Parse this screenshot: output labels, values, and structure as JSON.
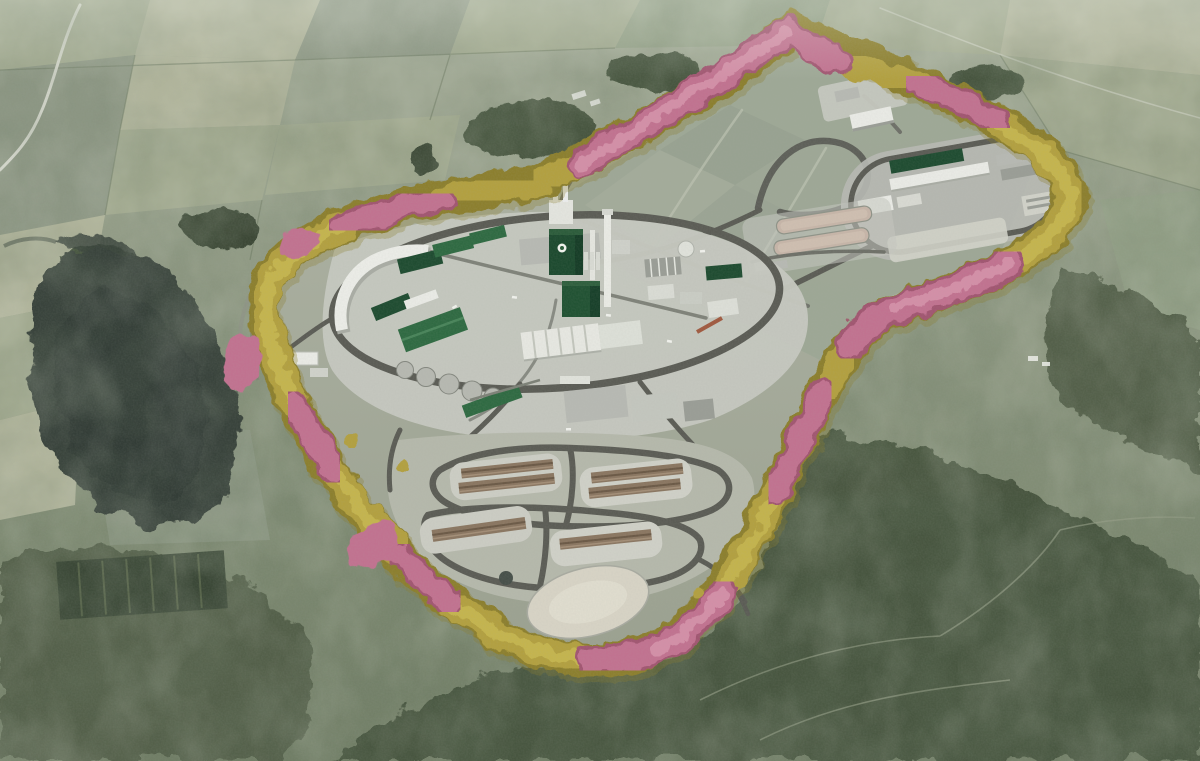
{
  "scene": {
    "type": "3d-aerial-render",
    "subject": "industrial pulp mill complex in rural countryside",
    "view": "oblique aerial",
    "features": [
      "perimeter buffer of yellow and pink trees around plant site",
      "central mill with dark green recovery-boiler buildings and white chimney stacks",
      "circular ring road around central mill platform",
      "round storage tanks and white sawtooth warehouse",
      "log storage yards with brown timber piles",
      "wastewater treatment lobe with oval ring road and settling basins",
      "sandy emergency pond",
      "dark reservoir lake at left",
      "patchwork farmland at top, dark forest at bottom right"
    ]
  },
  "palette": {
    "field_light": "#a2aa90",
    "field_pale": "#b0b49b",
    "field_mid": "#8e9885",
    "field_mid2": "#93a087",
    "forest_dark": "#45523d",
    "forest_deep": "#3a4736",
    "scrub": "#535f49",
    "lake": "#39423b",
    "site_ground": "#a5aa9b",
    "graded_field": "#9ca695",
    "pavement": "#c5c7bf",
    "pavement_bright": "#d0d1c8",
    "road_dark": "#5b5c55",
    "road_mid": "#6e7068",
    "lane_light": "#bcc2b1",
    "building_white": "#e9eae5",
    "building_gray": "#b7b9b3",
    "building_gray_dark": "#9a9d96",
    "green_dark": "#1f4c31",
    "green_mid": "#2f6a42",
    "green_light": "#49845a",
    "tank_gray": "#b6b8b1",
    "log_brown": "#8a7661",
    "log_dark": "#6b5946",
    "log_light": "#a38e77",
    "basin_tan": "#c6b5a8",
    "pond_sand": "#d7d3c5",
    "tree_yellow": "#b2a040",
    "tree_yellow_light": "#c8b851",
    "tree_yellow_dark": "#8c7f2e",
    "tree_pink": "#c17290",
    "tree_pink_light": "#d795ac",
    "tree_pink_dark": "#a15671",
    "country_road": "#d9dcd2"
  }
}
